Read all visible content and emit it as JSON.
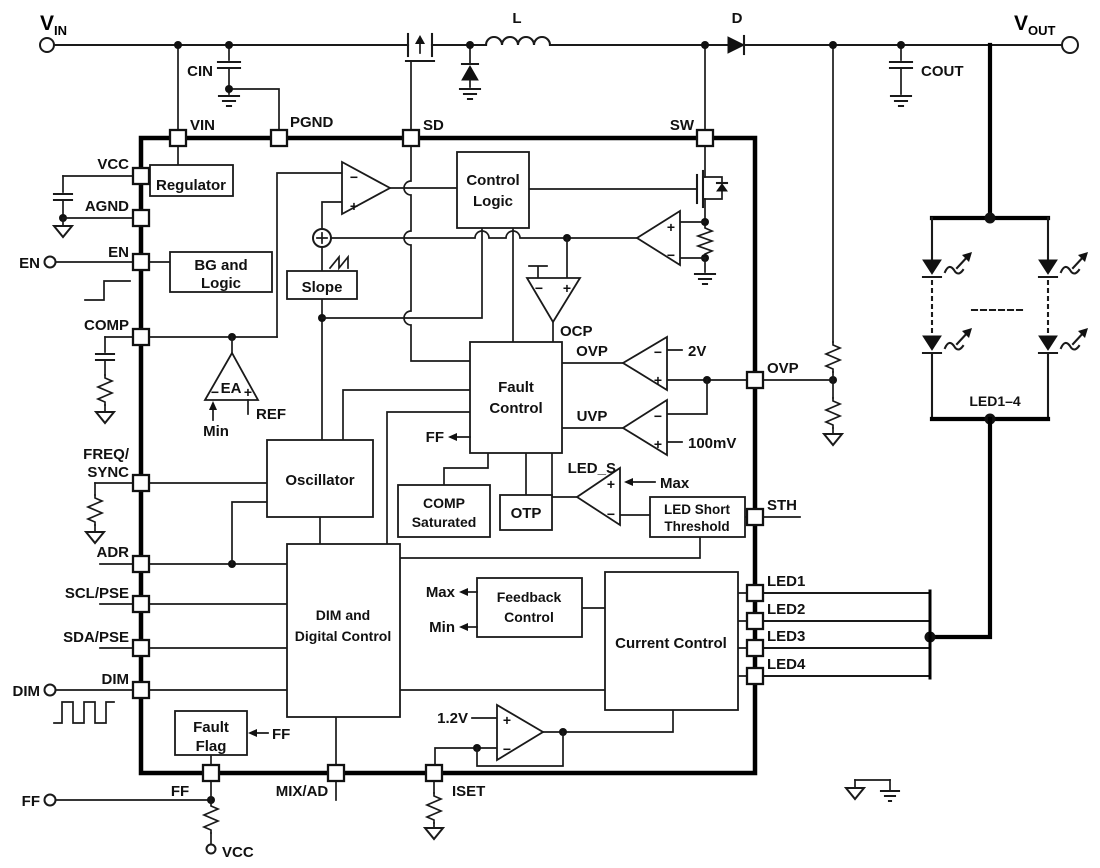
{
  "titles": {
    "vin_main": "V",
    "vin_sub": "IN",
    "vout_main": "V",
    "vout_sub": "OUT"
  },
  "components": {
    "cin": "CIN",
    "cout": "COUT",
    "inductor": "L",
    "diode": "D",
    "led_group": "LED1–4"
  },
  "terminals": {
    "en": "EN",
    "dim": "DIM",
    "ff": "FF",
    "vcc": "VCC"
  },
  "pins": {
    "vin": "VIN",
    "pgnd": "PGND",
    "sd": "SD",
    "sw": "SW",
    "vcc": "VCC",
    "agnd": "AGND",
    "en": "EN",
    "comp": "COMP",
    "freq": "FREQ/",
    "sync": "SYNC",
    "adr": "ADR",
    "scl": "SCL/PSE",
    "sda": "SDA/PSE",
    "dim": "DIM",
    "ovp": "OVP",
    "sth": "STH",
    "led1": "LED1",
    "led2": "LED2",
    "led3": "LED3",
    "led4": "LED4",
    "ff": "FF",
    "mixad": "MIX/AD",
    "iset": "ISET"
  },
  "blocks": {
    "regulator": "Regulator",
    "bg_line1": "BG and",
    "bg_line2": "Logic",
    "slope": "Slope",
    "control_line1": "Control",
    "control_line2": "Logic",
    "oscillator": "Oscillator",
    "fault_line1": "Fault",
    "fault_line2": "Control",
    "compsat_line1": "COMP",
    "compsat_line2": "Saturated",
    "otp": "OTP",
    "ledshort_line1": "LED Short",
    "ledshort_line2": "Threshold",
    "dim_line1": "DIM and",
    "dim_line2": "Digital Control",
    "feedback_line1": "Feedback",
    "feedback_line2": "Control",
    "current": "Current Control",
    "faultflag_line1": "Fault",
    "faultflag_line2": "Flag"
  },
  "signals": {
    "ea": "EA",
    "ref": "REF",
    "min": "Min",
    "max": "Max",
    "ocp": "OCP",
    "ovp": "OVP",
    "uvp": "UVP",
    "v2": "2V",
    "mv100": "100mV",
    "led_s": "LED_S",
    "ff": "FF",
    "v1p2": "1.2V",
    "plus": "+",
    "minus": "−"
  }
}
